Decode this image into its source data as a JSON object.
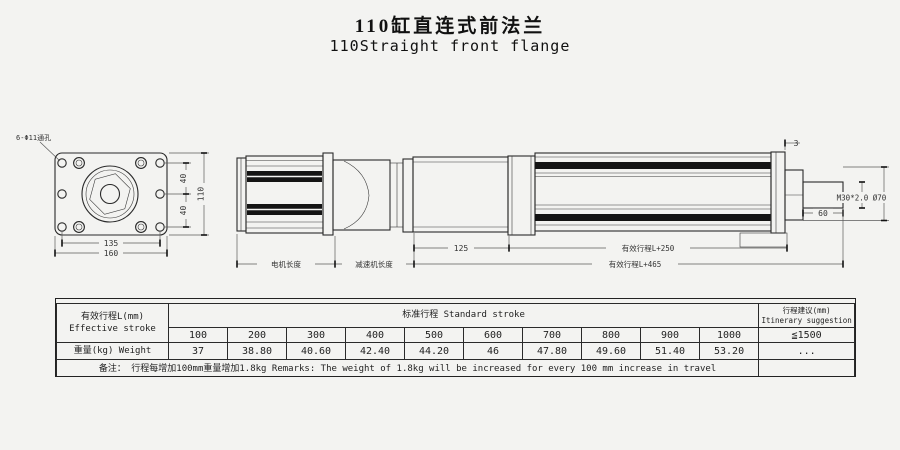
{
  "title": {
    "cn": "110缸直连式前法兰",
    "en": "110Straight front flange"
  },
  "drawing": {
    "front_view": {
      "hole_label": "6-Φ11通孔",
      "dim_hole_spacing_h": "135",
      "dim_width": "160",
      "dim_hole_v_top": "40",
      "dim_hole_v_bottom": "40",
      "dim_height": "110"
    },
    "side_view": {
      "dim_motor_length": "电机长度",
      "dim_reducer_length": "减速机长度",
      "dim_flange_block": "125",
      "dim_stroke_plus_250": "有效行程L+250",
      "dim_stroke_plus_465": "有效行程L+465",
      "dim_plate": "3",
      "dim_rod_extension": "60",
      "dim_rod_thread": "M30*2.0 Ø70"
    }
  },
  "table": {
    "effective_stroke_cn": "有效行程L(mm)",
    "effective_stroke_en": "Effective stroke",
    "standard_stroke_label": "标准行程  Standard stroke",
    "suggestion_cn": "行程建议(mm)",
    "suggestion_en": "Itinerary suggestion",
    "strokes": [
      "100",
      "200",
      "300",
      "400",
      "500",
      "600",
      "700",
      "800",
      "900",
      "1000"
    ],
    "suggestion_value": "≦1500",
    "weight_label": "重量(kg) Weight",
    "weights": [
      "37",
      "38.80",
      "40.60",
      "42.40",
      "44.20",
      "46",
      "47.80",
      "49.60",
      "51.40",
      "53.20"
    ],
    "weight_suggestion": "...",
    "remarks": "备注： 行程每增加100mm重量增加1.8kg   Remarks: The weight of 1.8kg will be increased for every 100 mm increase in travel"
  }
}
